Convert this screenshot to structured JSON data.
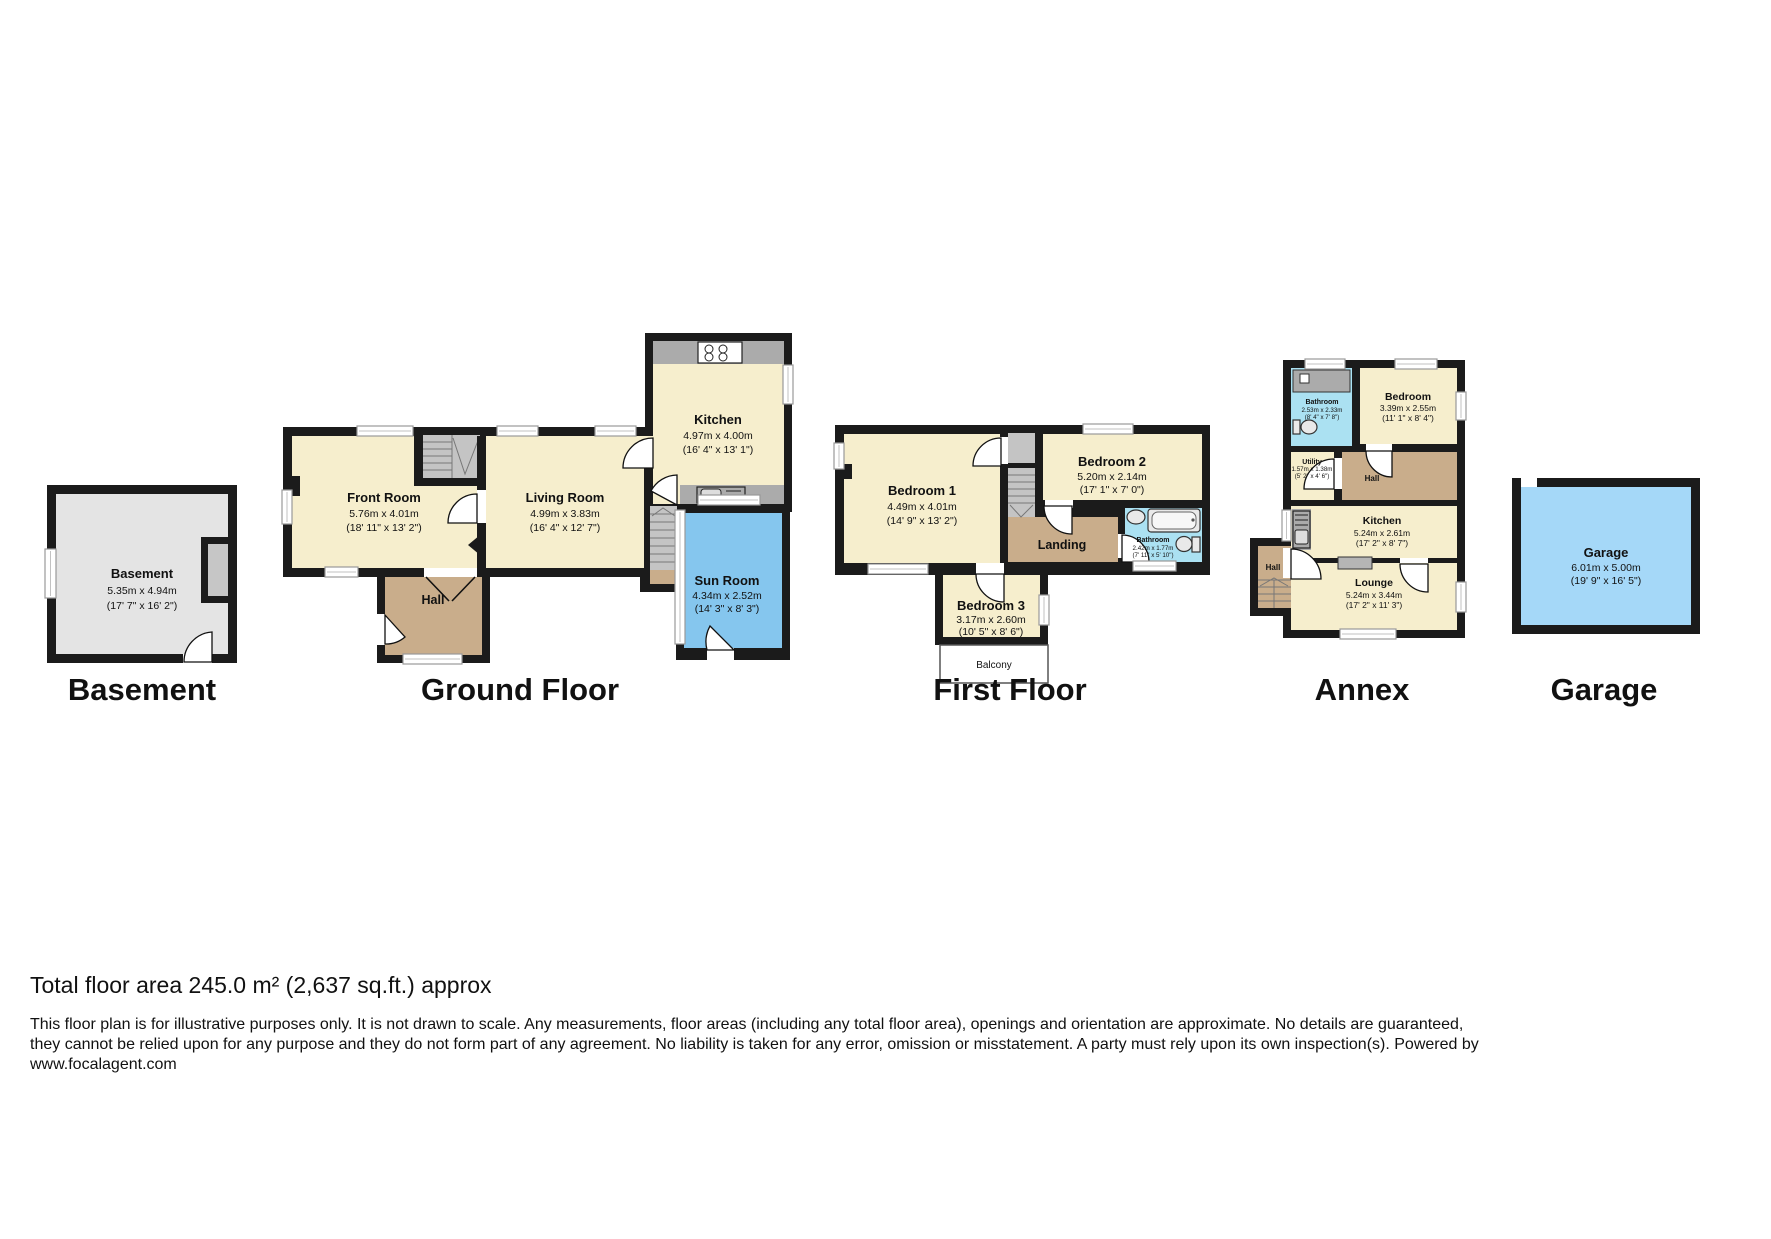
{
  "floor_titles": {
    "basement": "Basement",
    "ground": "Ground Floor",
    "first": "First Floor",
    "annex": "Annex",
    "garage": "Garage"
  },
  "rooms": {
    "basement": {
      "name": "Basement",
      "m": "5.35m x 4.94m",
      "i": "(17' 7\" x 16' 2\")"
    },
    "gf_front": {
      "name": "Front Room",
      "m": "5.76m x 4.01m",
      "i": "(18' 11\" x 13' 2\")"
    },
    "gf_living": {
      "name": "Living Room",
      "m": "4.99m x 3.83m",
      "i": "(16' 4\" x 12' 7\")"
    },
    "gf_kitchen": {
      "name": "Kitchen",
      "m": "4.97m x 4.00m",
      "i": "(16' 4\" x 13' 1\")"
    },
    "gf_sun": {
      "name": "Sun Room",
      "m": "4.34m x 2.52m",
      "i": "(14' 3\" x 8' 3\")"
    },
    "gf_hall": {
      "name": "Hall"
    },
    "ff_bed1": {
      "name": "Bedroom 1",
      "m": "4.49m x 4.01m",
      "i": "(14' 9\" x 13' 2\")"
    },
    "ff_bed2": {
      "name": "Bedroom 2",
      "m": "5.20m x 2.14m",
      "i": "(17' 1\" x 7' 0\")"
    },
    "ff_bed3": {
      "name": "Bedroom 3",
      "m": "3.17m x 2.60m",
      "i": "(10' 5\" x 8' 6\")"
    },
    "ff_bath": {
      "name": "Bathroom",
      "m": "2.42m x 1.77m",
      "i": "(7' 11\" x 5' 10\")"
    },
    "ff_landing": {
      "name": "Landing"
    },
    "ff_balcony": {
      "name": "Balcony"
    },
    "ax_bath": {
      "name": "Bathroom",
      "m": "2.53m x 2.33m",
      "i": "(8' 4\" x 7' 8\")"
    },
    "ax_bed": {
      "name": "Bedroom",
      "m": "3.39m x 2.55m",
      "i": "(11' 1\" x 8' 4\")"
    },
    "ax_utility": {
      "name": "Utility",
      "m": "1.57m x 1.38m",
      "i": "(5' 2\" x 4' 6\")"
    },
    "ax_hall": {
      "name": "Hall"
    },
    "ax_kitchen": {
      "name": "Kitchen",
      "m": "5.24m x 2.61m",
      "i": "(17' 2\" x 8' 7\")"
    },
    "ax_lounge": {
      "name": "Lounge",
      "m": "5.24m x 3.44m",
      "i": "(17' 2\" x 11' 3\")"
    },
    "ax_hall2": {
      "name": "Hall"
    },
    "garage": {
      "name": "Garage",
      "m": "6.01m x 5.00m",
      "i": "(19' 9\" x 16' 5\")"
    }
  },
  "footer": {
    "total": "Total floor area 245.0 m² (2,637 sq.ft.) approx",
    "line1": "This floor plan is for illustrative purposes only. It is not drawn to scale. Any measurements, floor areas (including any total floor area), openings and orientation are approximate. No details are guaranteed,",
    "line2": "they cannot be relied upon for any purpose and they do not form part of any agreement. No liability is taken for any error, omission or misstatement. A party must rely upon its own inspection(s). Powered by",
    "line3": "www.focalagent.com"
  },
  "colors": {
    "wall": "#1b1b1b",
    "room_cream": "#f6eecd",
    "hall_tan": "#c9ad8b",
    "basement_gray": "#e4e4e4",
    "stairs_gray": "#c4c4c4",
    "counter_gray": "#ababab",
    "sun_room_blue": "#85c6ee",
    "bathroom_blue": "#abe1f2",
    "garage_blue": "#a5d8f8"
  }
}
